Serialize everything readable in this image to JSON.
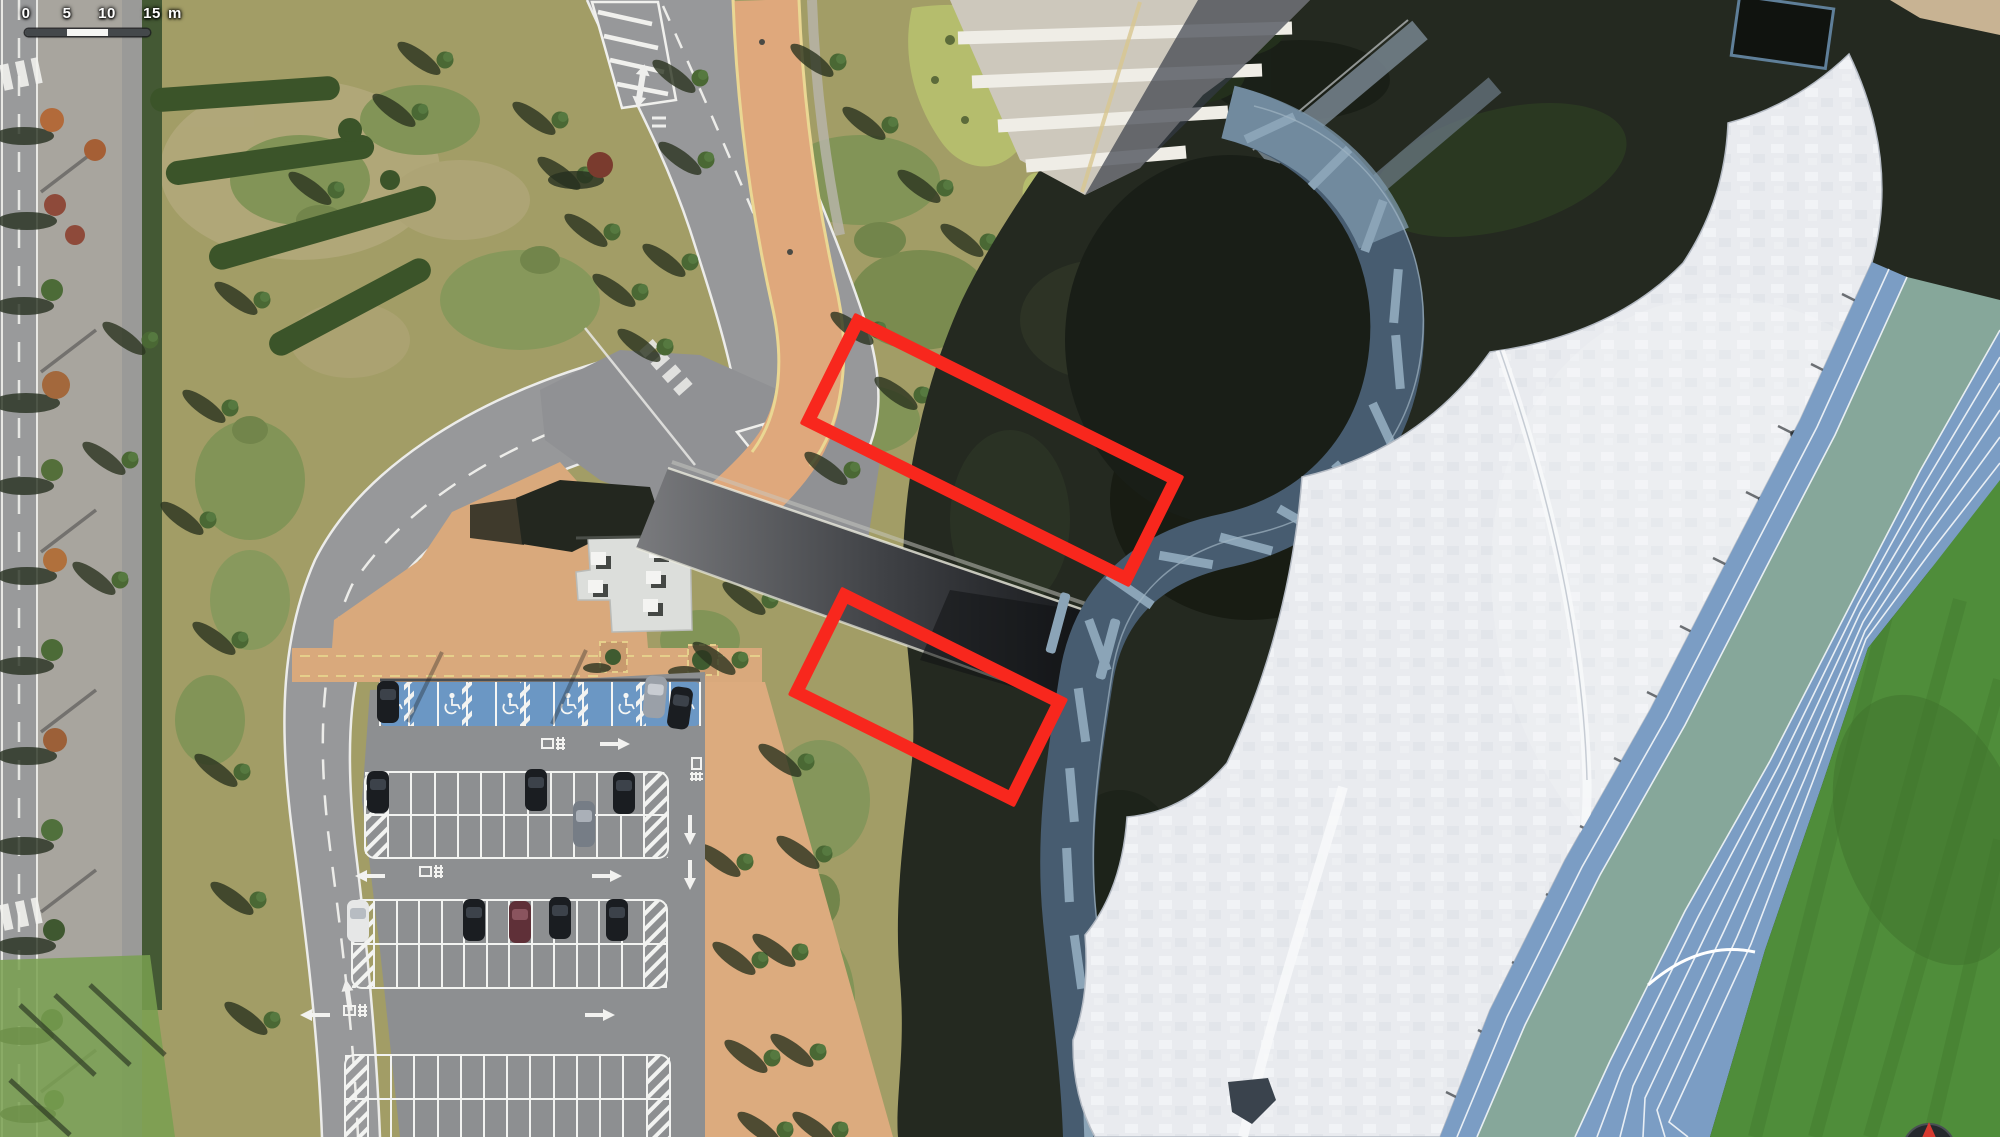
{
  "map": {
    "kind": "satellite-orthophoto",
    "scene": "stadium with white canopy roof, blue running track, amphitheater walkways, curved access roads, tree-lined street and surface parking lot with accessible stalls"
  },
  "scale_bar": {
    "ticks": [
      "0",
      "5",
      "10",
      "15"
    ],
    "unit": "m",
    "bar_dark_color": "#44484b",
    "bar_light_color": "#f5f5f3"
  },
  "annotations": {
    "stroke_color": "#f8271d",
    "stroke_width": 13,
    "boxes": [
      {
        "cx": 992,
        "cy": 450,
        "width": 368,
        "height": 124,
        "rotation_deg": 26.4
      },
      {
        "cx": 928,
        "cy": 697,
        "width": 253,
        "height": 121,
        "rotation_deg": 26.4
      }
    ]
  },
  "compass": {
    "icon": "compass-icon",
    "needle_color": "#d63a2f"
  },
  "theme": {
    "grass_sunlit": "#a29d66",
    "grass_green": "#7d9355",
    "shadow_dark": "#242920",
    "asphalt": "#97989a",
    "parking_asphalt": "#8d8f91",
    "path_tan": "#d9a97c",
    "path_yellow_line": "#e6cf8b",
    "accessible_blue": "#6b97c4",
    "roof_white": "#e9ebef",
    "track_blue": "#7b9dc4",
    "track_apron_teal": "#86a79a",
    "field_green": "#4f8d3a",
    "walkway_bluegray": "#475c70",
    "walkway_step_light": "#8ba4b7"
  }
}
